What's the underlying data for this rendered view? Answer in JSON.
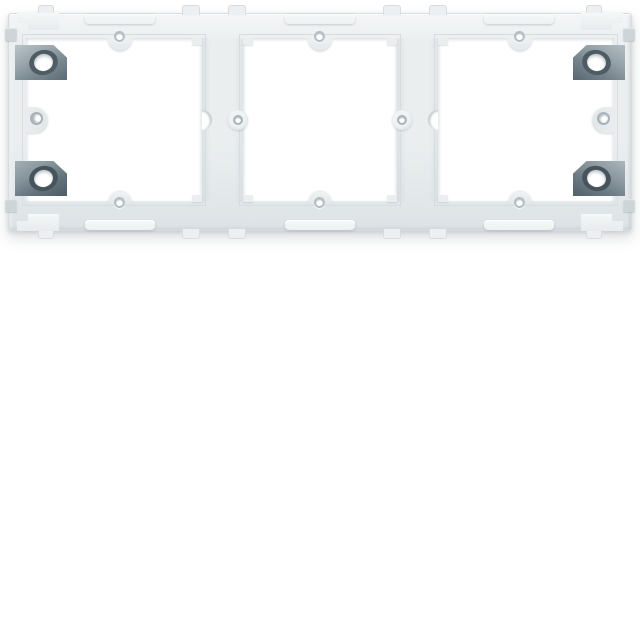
{
  "scene": {
    "type": "product-photo",
    "subject": "White plastic triple (3-gang) flush-mounting frame for electrical wall modules, viewed from the front",
    "background_color": "#ffffff",
    "object_position": "horizontal band across the upper third of the image",
    "contains_text": false
  },
  "palette": {
    "bg": "#ffffff",
    "frame-light": "#f4f6f7",
    "frame-base": "#eaeeef",
    "frame-mid": "#e2e8ea",
    "edge-line": "#d6dcdf",
    "metal-light": "#9aa7ad",
    "metal-dark": "#5d6c75",
    "hole-rim": "#4e5c64"
  },
  "object": {
    "name": "3-gang mounting frame",
    "material": "molded plastic",
    "color": "white",
    "openings": {
      "count": 3,
      "shape": "square window",
      "separators": "I-shaped plastic dividers with stepped corners"
    },
    "metal_claws": {
      "count": 4,
      "color": "gray metal",
      "positions": [
        "top-left",
        "bottom-left",
        "top-right",
        "bottom-right"
      ],
      "feature": "oval screw hole in each claw"
    },
    "screw_tabs": {
      "count": 6,
      "description": "small round-hole bulges at top and bottom center of each window"
    },
    "side_lugs": {
      "count": 2,
      "description": "rounded lugs with small holes at mid-height of left and right outer bands"
    },
    "divider_features": {
      "count": 4,
      "description": "crescent notch and circular hole lug at mid-height of each divider edge"
    },
    "edge_details": [
      "retaining tabs along top and bottom edges",
      "raised ridge bars",
      "L-shaped corner clips",
      "small gray side bumps"
    ]
  }
}
